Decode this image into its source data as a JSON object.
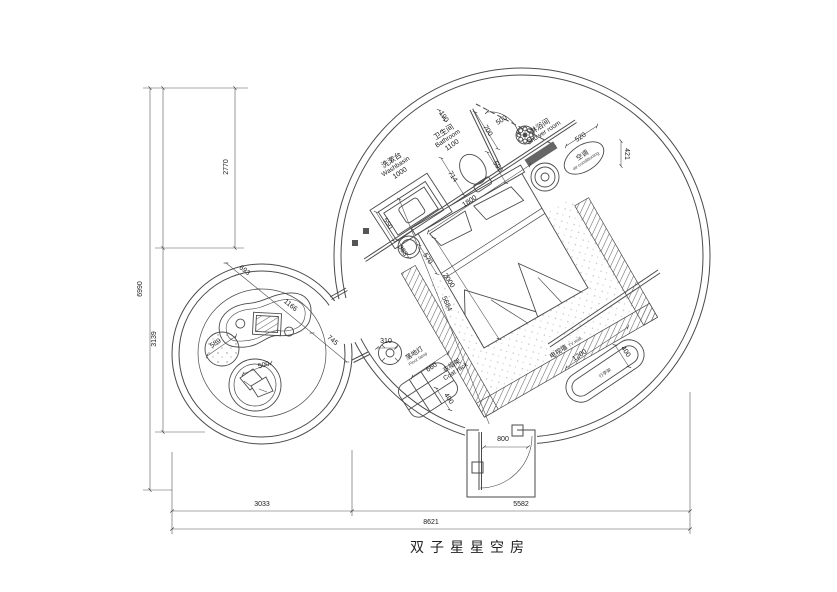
{
  "title": "双子星星空房",
  "colors": {
    "line": "#4a4a4a",
    "text": "#1a1a1a",
    "bg": "#ffffff"
  },
  "rooms": {
    "bathroom": {
      "cn": "卫生间",
      "en": "Bathroom",
      "dim": "1100"
    },
    "washbasin": {
      "cn": "洗漱台",
      "en": "Washbasin",
      "dim": "1000"
    },
    "shower": {
      "cn": "淋浴间",
      "en": "Shower room"
    },
    "air_conditioner": {
      "cn": "空调",
      "en": "air-conditioning"
    },
    "tv_wall": {
      "cn": "电视墙",
      "en": "TV wall"
    },
    "floor_lamp": {
      "cn": "落地灯",
      "en": "Floor lamp"
    },
    "coat_rack": {
      "cn": "衣帽架",
      "en": "Coat rack"
    },
    "luggage_rack": {
      "cn": "行李架"
    }
  },
  "dims": {
    "overall_h": "6990",
    "seg_h_top": "2770",
    "seg_h_bottom": "3139",
    "overall_w": "8621",
    "seg_w_left": "3033",
    "seg_w_right": "5582",
    "bath_190": "190",
    "bath_700": "700",
    "shower_door_500": "500",
    "toilet_590": "590",
    "basin_550": "550",
    "basin_714": "714",
    "bed_w_1800": "1800",
    "bed_l_2000": "2000",
    "stool_363": "363",
    "stool_570": "570",
    "diag_5684": "5684",
    "ac_520": "520",
    "ac_421": "421",
    "tv_1200": "1200",
    "tv_400": "400",
    "lamp_310": "310",
    "coat_660": "660",
    "coat_400": "400",
    "door_800": "800",
    "left_693": "693",
    "left_1166": "1166",
    "left_745": "745",
    "rug_589": "589",
    "chair_500": "500"
  }
}
